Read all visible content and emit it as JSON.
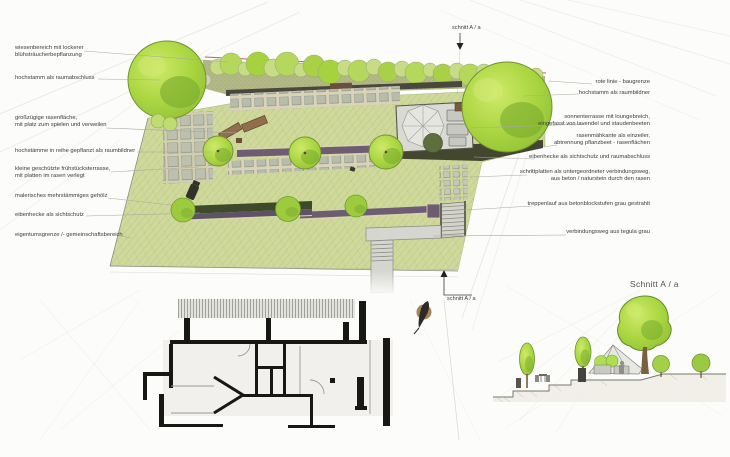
{
  "labels": {
    "left": [
      {
        "text": "wiesenbereich mit lockerer\nblühsträucherbepflanzung"
      },
      {
        "text": "hochstamm als raumabschluss"
      },
      {
        "text": "großzügige rasenfläche,\nmit platz zum spielen und verweilen"
      },
      {
        "text": "hochstämme in reihe gepflanzt als raumbildner"
      },
      {
        "text": "kleine geschützte frühstücksterrasse,\nmit platten im rasen verlegt"
      },
      {
        "text": "malerisches mehrstämmiges gehölz"
      },
      {
        "text": "eibenhecke als sichtschutz"
      },
      {
        "text": "eigentumsgrenze /- gemeinschaftsbereich"
      }
    ],
    "right": [
      {
        "text": "rote linie - baugrenze"
      },
      {
        "text": "hochstamm als raumbildner"
      },
      {
        "text": "sonnenterrasse mit loungebreich,\neingefasst von lavendel und staudenbeeten"
      },
      {
        "text": "rasenmähkante als einzeiler,\nabtrennung pflanzbeet - rasenflächen"
      },
      {
        "text": "eibenhecke als sichtschutz und raumabschluss"
      },
      {
        "text": "schrittplatten als untergeordneter verbindungsweg,\naus beton / naturstein durch den rasen"
      },
      {
        "text": "treppenlauf aus betonblockstufen grau gestrahlt"
      },
      {
        "text": "verbindungsweg aus tegula grau"
      }
    ]
  },
  "section_markers": {
    "top": "schnitt A / a",
    "bottom": "schnitt A / a"
  },
  "section_view": {
    "title": "Schnitt A / a"
  },
  "icons": {
    "section_arrow_top": "arrow-down",
    "section_arrow_bottom": "arrow-up",
    "bird": "bird-silhouette"
  },
  "colors": {
    "paper": "#fcfcfa",
    "lawn": "#cfd99b",
    "meadow_band": "#b3b887",
    "shrub_band": "#c7dc85",
    "tree_light": "#cfe96a",
    "tree_mid": "#a9d544",
    "tree_dark": "#79aa2e",
    "purple_bed": "#6d5c72",
    "hedge_dark": "#3d4a2c",
    "edging_beige": "#ddd3b4",
    "paver": "#b8bcab",
    "path_gray": "#d6d6d0",
    "terrace_gray": "#dadad5",
    "stair_side": "#5a584f",
    "building_wall": "#191713",
    "red_building_line": "#b0493f",
    "bird_brown": "#9a7845",
    "label_text": "#3b3b38"
  }
}
